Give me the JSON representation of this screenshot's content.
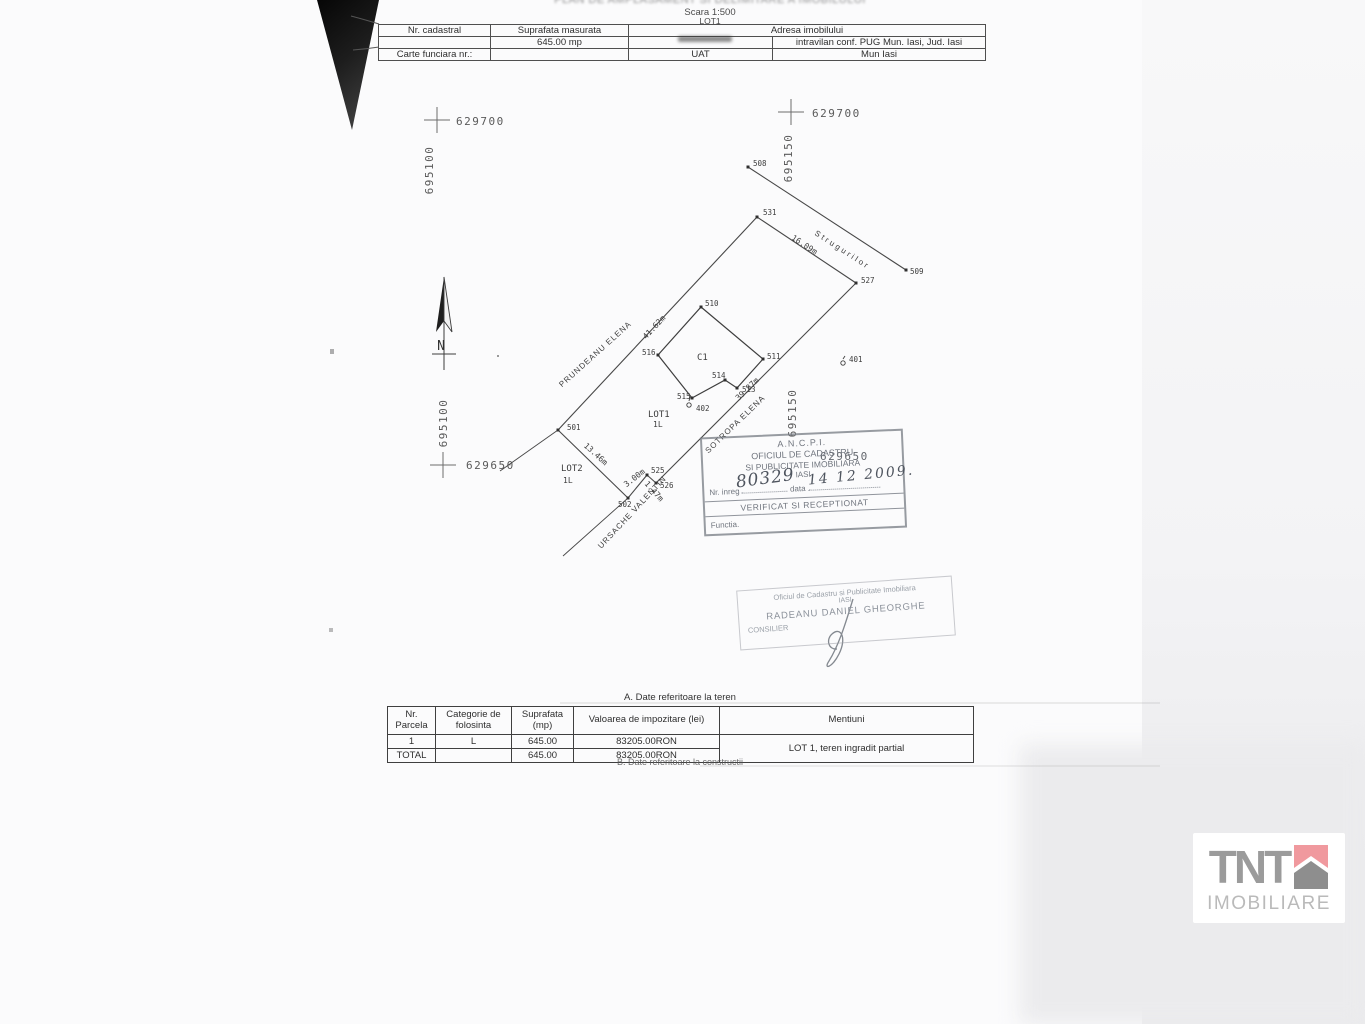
{
  "page": {
    "title_fragment": "PLAN DE AMPLASAMENT SI DELIMITARE A IMOBILULUI",
    "scale": "Scara 1:500",
    "lot": "LOT1"
  },
  "header_table": {
    "nr_cadastral_label": "Nr. cadastral",
    "suprafata_label": "Suprafata masurata",
    "suprafata_value": "645.00 mp",
    "adresa_label": "Adresa imobilului",
    "adresa_value": "intravilan conf. PUG Mun. Iasi, Jud. Iasi",
    "carte_funciara_label": "Carte funciara nr.:",
    "uat_label": "UAT",
    "uat_value": "Mun Iasi"
  },
  "plan": {
    "grid_labels": [
      {
        "x": "629700",
        "y": "695100"
      },
      {
        "x": "629700",
        "y": "695150"
      },
      {
        "x": "629650",
        "y": "695100"
      },
      {
        "x": "629650",
        "y": "695150"
      }
    ],
    "north": "N",
    "street": "Strugurilor",
    "neighbors": [
      "PRUNDEANU ELENA",
      "SOTROPA ELENA",
      "URSACHE VALENTIN"
    ],
    "building": "C1",
    "lot_labels": {
      "lot1": "LOT1",
      "lot1_sub": "1L",
      "lot2": "LOT2",
      "lot2_sub": "1L"
    },
    "points": {
      "p501": "501",
      "p502": "502",
      "p508": "508",
      "p509": "509",
      "p510": "510",
      "p511": "511",
      "p513": "513",
      "p514": "514",
      "p515": "515",
      "p516": "516",
      "p525": "525",
      "p526": "526",
      "p527": "527",
      "p531": "531",
      "p401": "401",
      "p402": "402"
    },
    "distances": {
      "d1": "41.62m",
      "d2": "16.09m",
      "d3": "39.87m",
      "d4": "13.46m",
      "d5": "3.00m",
      "d6": "1.47m"
    }
  },
  "stamps": {
    "ancpi": {
      "l1": "A.N.C.P.I.",
      "l2": "OFICIUL DE CADASTRU",
      "l3": "SI PUBLICITATE IMOBILIARA",
      "l4": "IASI",
      "nr_label": "Nr. inreg",
      "nr_value": "80329",
      "date_label": "data",
      "date_value": "14 12 2009.",
      "verified": "VERIFICAT SI RECEPTIONAT",
      "functia": "Functia."
    },
    "consilier": {
      "l1": "Oficiul de Cadastru si Publicitate Imobiliara",
      "l2": "IASI",
      "name": "RADEANU DANIEL GHEORGHE",
      "role": "CONSILIER"
    }
  },
  "teren_table": {
    "caption": "A. Date referitoare la teren",
    "col_nr": "Nr. Parcela",
    "col_cat": "Categorie de folosinta",
    "col_sup": "Suprafata (mp)",
    "col_val": "Valoarea de impozitare (lei)",
    "col_men": "Mentiuni",
    "rows": {
      "r1": {
        "nr": "1",
        "cat": "L",
        "sup": "645.00",
        "val": "83205.00RON",
        "men": "LOT 1, teren ingradit partial"
      },
      "total": {
        "nr": "TOTAL",
        "sup": "645.00",
        "val": "83205.00RON"
      }
    },
    "caption_b": "B. Date referitoare la constructii"
  },
  "watermark": {
    "brand": "TNT",
    "subtitle": "IMOBILIARE"
  }
}
